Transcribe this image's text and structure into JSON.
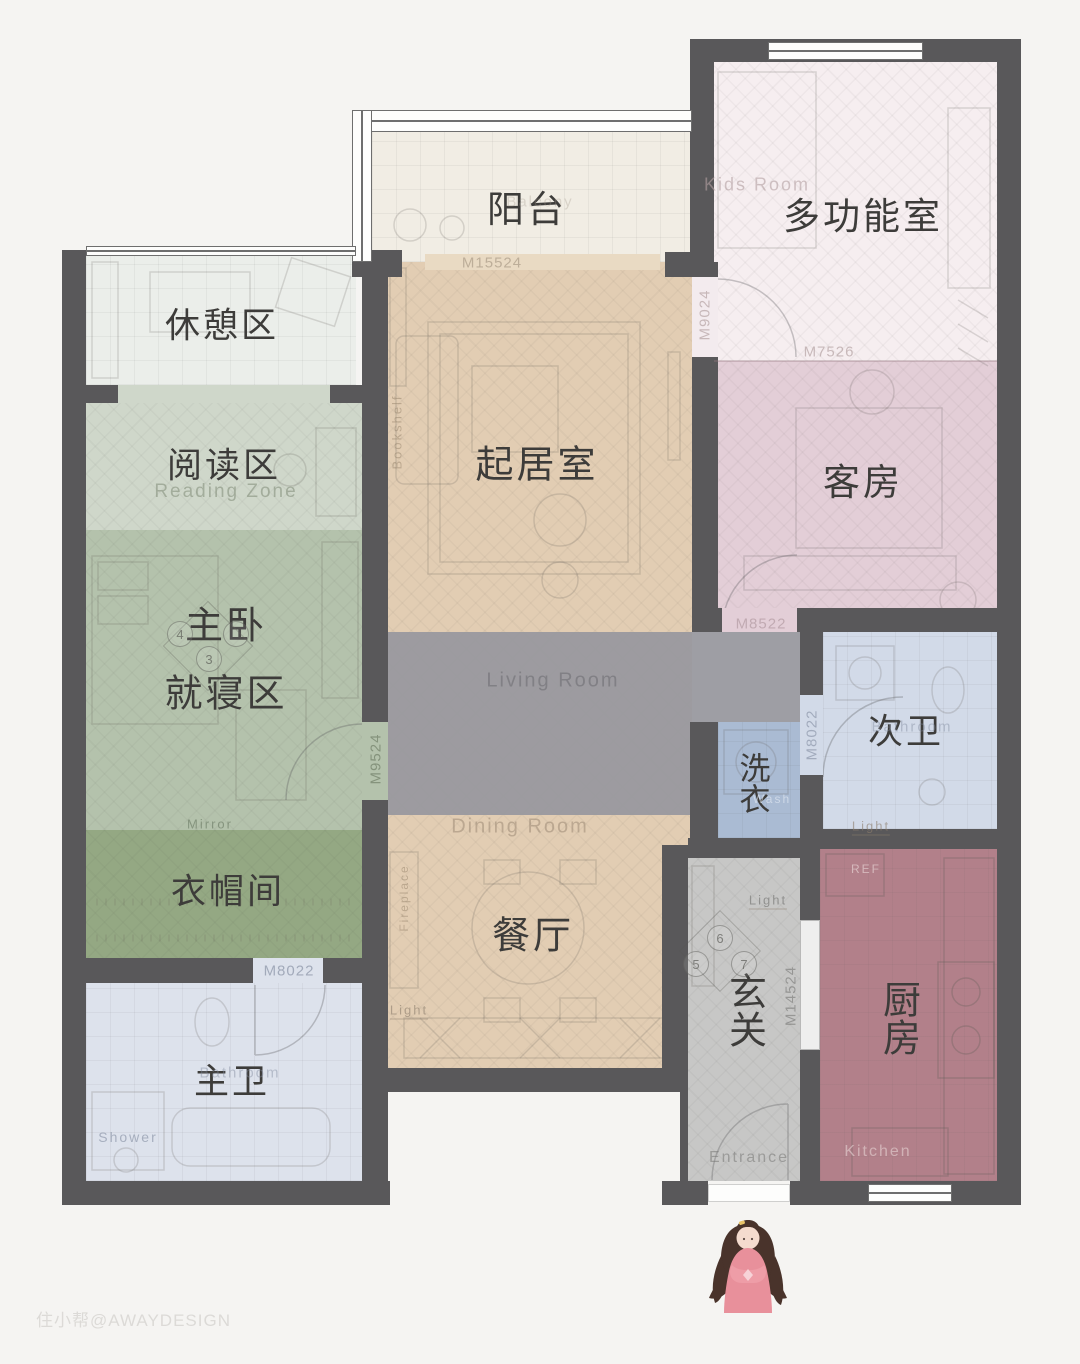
{
  "title": "apartment floor plan",
  "watermark": "住小帮@AWAYDESIGN",
  "palette": {
    "bg": "#f5f4f2",
    "wall": "#59585a",
    "rest": "#ebeeea",
    "reading": "#cfd7ca",
    "master": "#b4c2ac",
    "closet": "#94a883",
    "master_bath": "#dde2ec",
    "balcony": "#f1ede4",
    "living": "#e2cdb3",
    "corridor": "#9c9ca1",
    "multi": "#f6eef0",
    "guest": "#e3ced7",
    "second_bath": "#d2dae8",
    "laundry": "#aabbd3",
    "entrance": "#c7c7c6",
    "kitchen": "#b2808a",
    "threshold": "#e9dac3",
    "door_pink": "#f3ebee",
    "slide_door": "#efefee",
    "girl_dress": "#e8909b",
    "girl_hair": "#49332b"
  },
  "rooms": {
    "rest": {
      "label": "休憩区"
    },
    "reading": {
      "label": "阅读区",
      "en": "Reading Zone"
    },
    "master": {
      "label": "主卧",
      "label2": "就寝区",
      "mirror": "Mirror"
    },
    "closet": {
      "label": "衣帽间"
    },
    "master_bath": {
      "label": "主卫",
      "en": "Bathroom",
      "shower": "Shower"
    },
    "balcony": {
      "label": "阳台",
      "en": "Balcony"
    },
    "living": {
      "label": "起居室",
      "en": "Living Room",
      "bookshelf": "Bookshelf"
    },
    "dining": {
      "label": "餐厅",
      "en": "Dining Room",
      "fireplace": "Fireplace",
      "light": "Light"
    },
    "multi": {
      "label": "多功能室",
      "en": "Kids Room"
    },
    "guest": {
      "label": "客房"
    },
    "second_bath": {
      "label": "次卫",
      "en": "Bathroom"
    },
    "laundry": {
      "label": "洗衣",
      "en": "Wash"
    },
    "entrance": {
      "label": "玄关",
      "en": "Entrance",
      "light": "Light"
    },
    "kitchen": {
      "label": "厨房",
      "en": "Kitchen",
      "ref": "REF"
    }
  },
  "door_codes": {
    "balcony_living": "M15524",
    "living_multi": "M9024",
    "multi_guest": "M7526",
    "guest": "M8522",
    "second_bath": "M8022",
    "master": "M9524",
    "master_bath": "M8022",
    "kitchen": "M14524"
  },
  "markers": {
    "bedroom": [
      "4",
      "3"
    ],
    "entrance": [
      "6",
      "5",
      "7"
    ]
  }
}
